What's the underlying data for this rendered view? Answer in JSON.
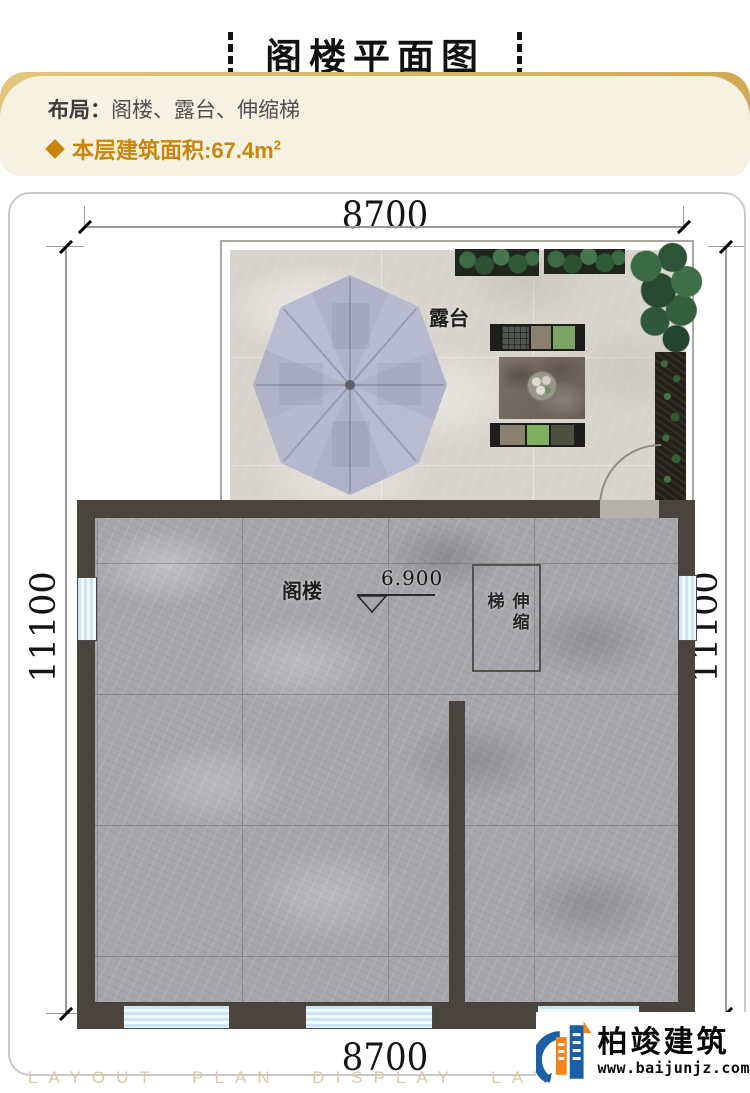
{
  "title": "阁楼平面图",
  "info": {
    "layout_label": "布局：",
    "layout_value": "阁楼、露台、伸缩梯",
    "area_text": "本层建筑面积:67.4m",
    "area_sup": "2"
  },
  "plan": {
    "dim_top": "8700",
    "dim_bottom": "8700",
    "dim_left": "11100",
    "dim_right": "11100",
    "terrace_label": "露台",
    "attic_label": "阁楼",
    "ladder_label": "伸缩梯",
    "level_value": "6.900"
  },
  "footer": {
    "watermark": "LAYOUT PLAN DISPLAY LAYOUT PLAN DISPLAY",
    "brand": "柏竣建筑",
    "site": "www.baijunjz.com"
  },
  "colors": {
    "accent_gold": "#c8860b",
    "panel_bg": "#f7f1e1",
    "wall": "#49443c",
    "marble": "#a6a6aa",
    "terrace_floor": "#d7d4cc",
    "umbrella": "#b4b7cc",
    "window_blue": "#cde6f5",
    "logo_blue": "#1b5fa5",
    "logo_orange": "#f08519",
    "watermark_color": "#dbc9a0"
  }
}
